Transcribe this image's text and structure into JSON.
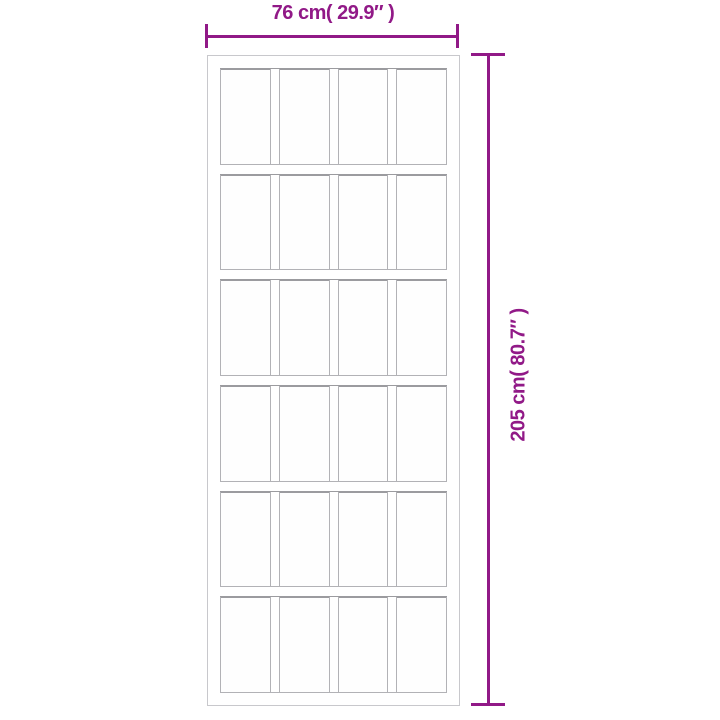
{
  "diagram": {
    "type": "product-dimension-diagram",
    "width_label": "76 cm( 29.9″ )",
    "height_label": "205 cm( 80.7″ )",
    "width_cm": 76,
    "width_in": 29.9,
    "height_cm": 205,
    "height_in": 80.7,
    "panel_grid": {
      "rows": 6,
      "columns": 4
    }
  },
  "colors": {
    "accent": "#911987",
    "frame": "#c8c8cc",
    "band-line-dark": "#9b9b9f",
    "band-line-light": "#b2b2b6",
    "background": "#ffffff"
  }
}
